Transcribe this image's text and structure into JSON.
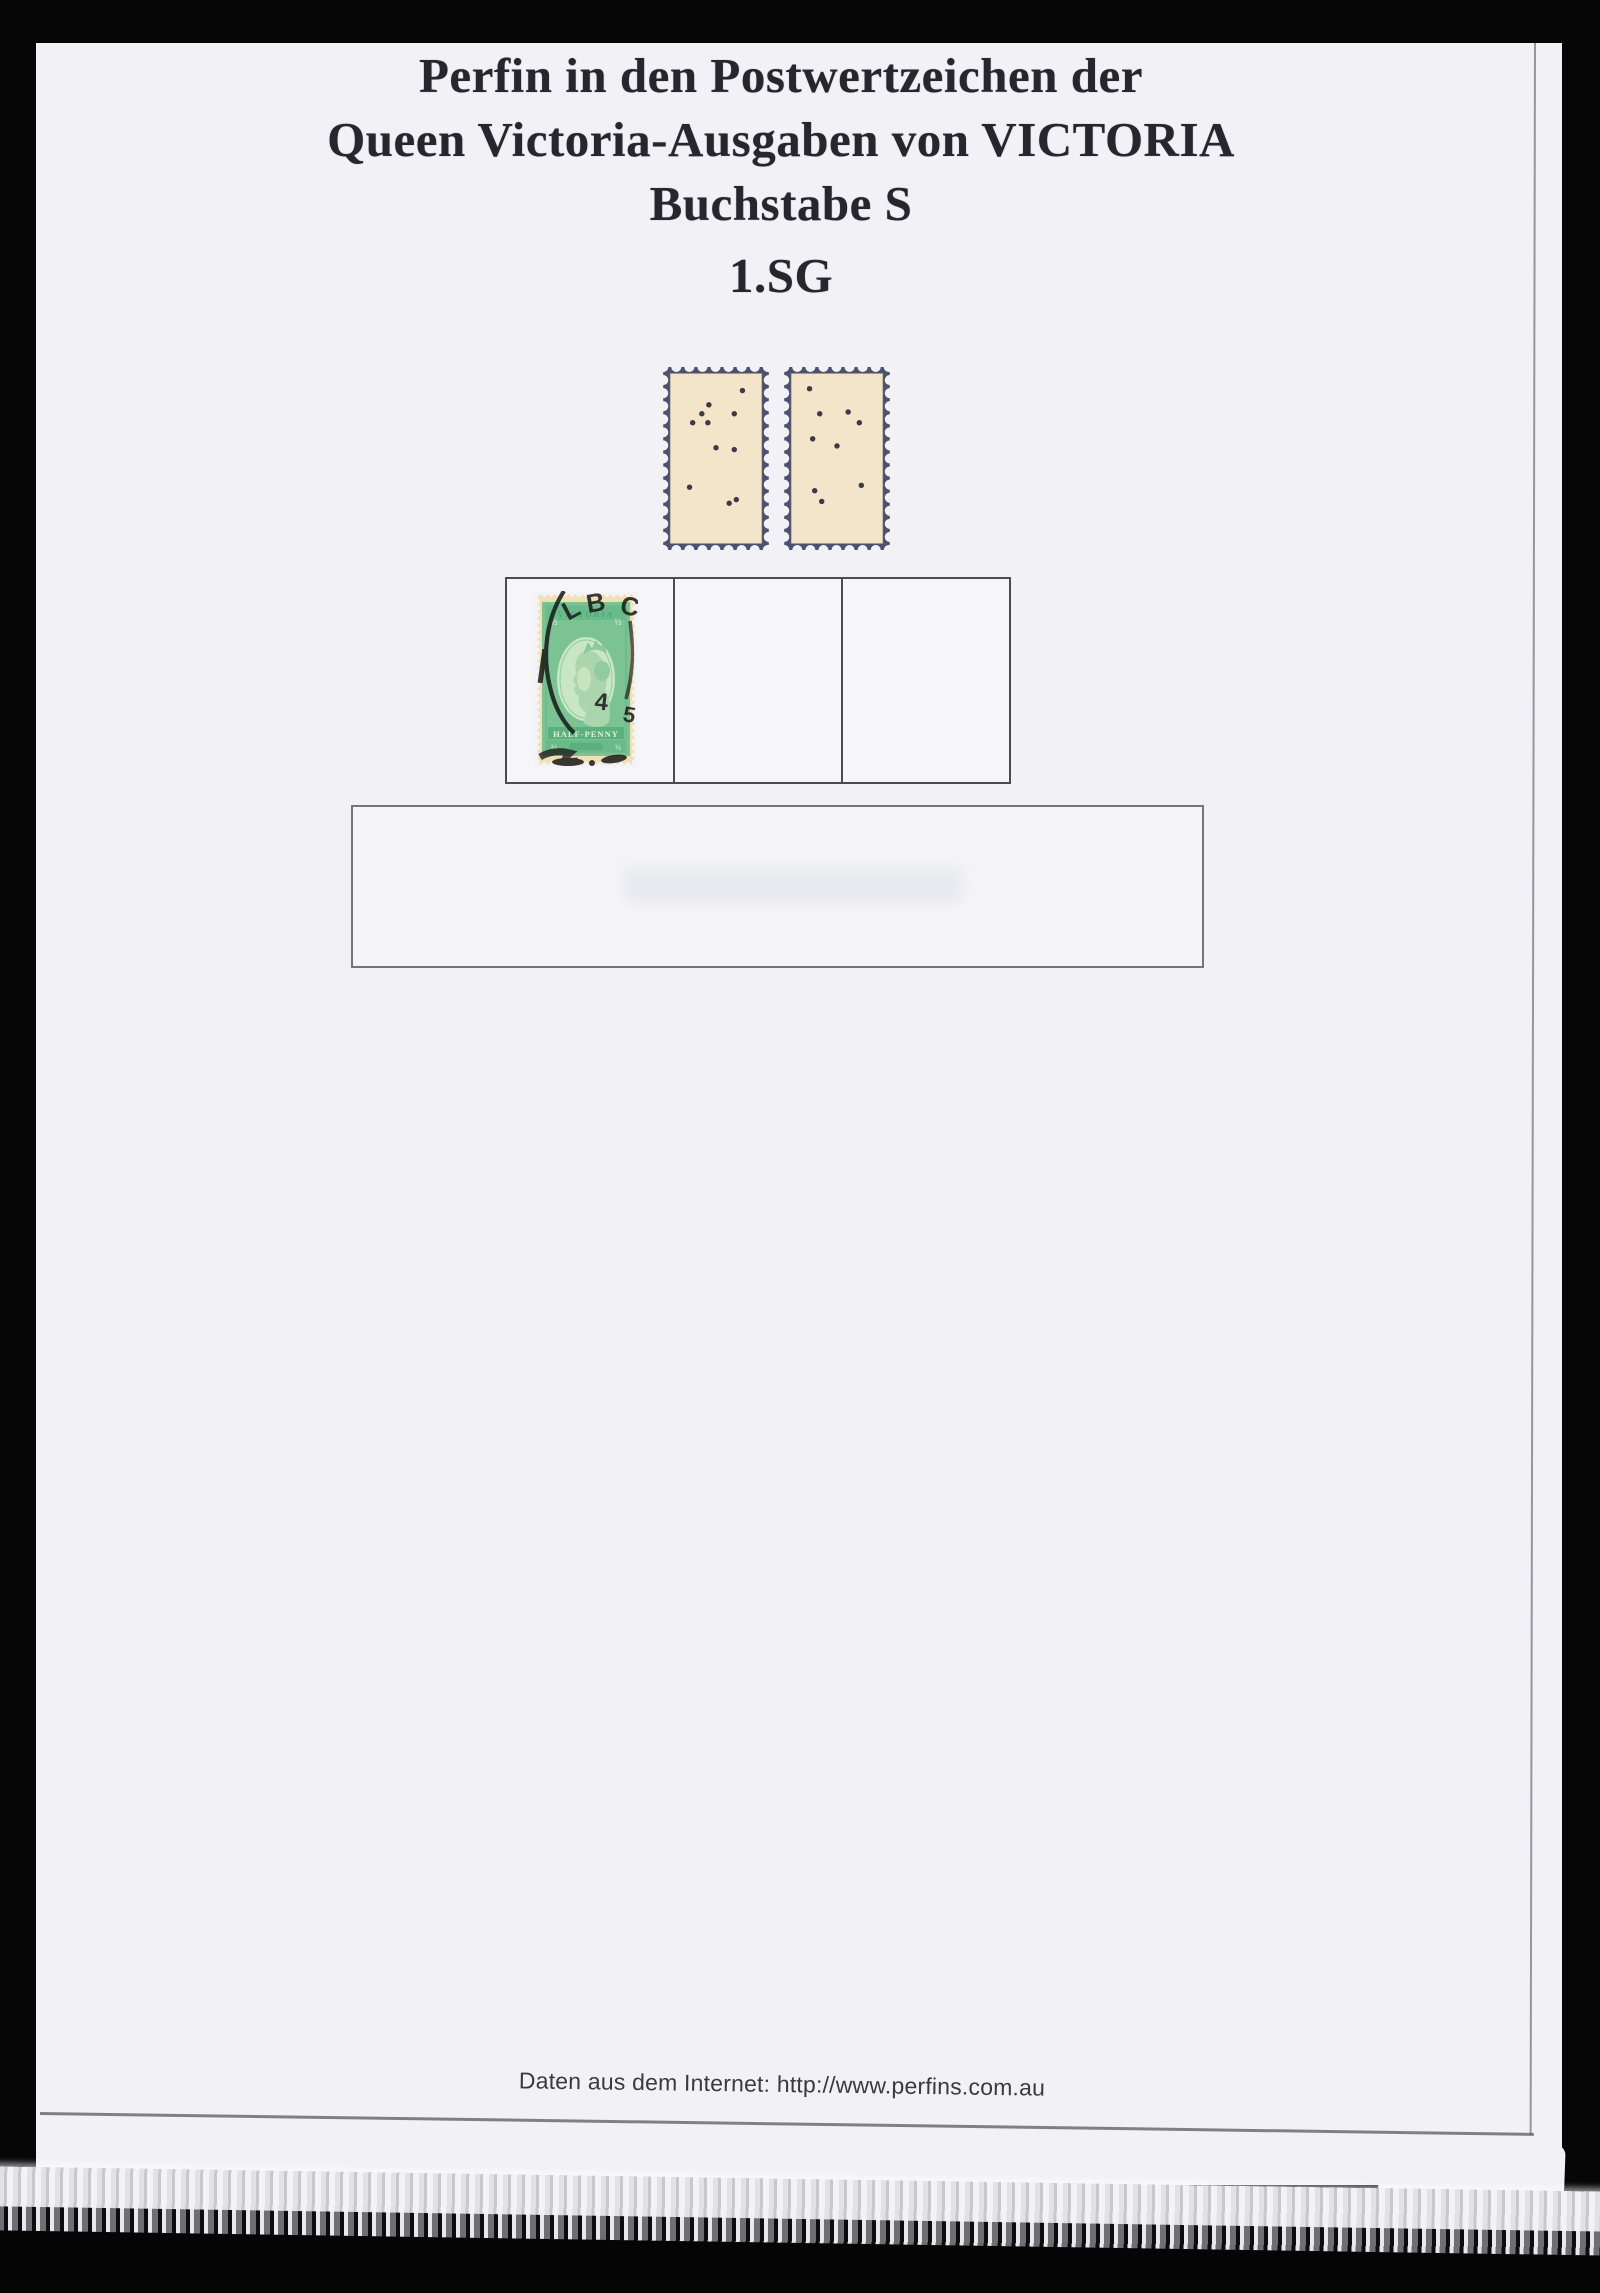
{
  "document": {
    "title_lines": [
      "Perfin in den Postwertzeichen der",
      "Queen Victoria-Ausgaben von VICTORIA",
      "Buchstabe S",
      "1.SG"
    ],
    "footer_source": "Daten aus dem Internet: http://www.perfins.com.au"
  },
  "perfin_backs": {
    "border_color": "#4d5170",
    "paper_color": "#f3e5c9",
    "hole_color": "#3b3b47",
    "page_color": "#f2f2f6",
    "stamps": [
      {
        "name": "perfin-back-left",
        "holes": [
          [
            76,
            12
          ],
          [
            43,
            20
          ],
          [
            36,
            25
          ],
          [
            68,
            25
          ],
          [
            27,
            30
          ],
          [
            42,
            30
          ],
          [
            50,
            44
          ],
          [
            68,
            45
          ],
          [
            24,
            66
          ],
          [
            70,
            73
          ],
          [
            63,
            75
          ]
        ]
      },
      {
        "name": "perfin-back-right",
        "holes": [
          [
            23,
            11
          ],
          [
            33,
            25
          ],
          [
            61,
            24
          ],
          [
            72,
            30
          ],
          [
            26,
            39
          ],
          [
            50,
            43
          ],
          [
            74,
            65
          ],
          [
            28,
            68
          ],
          [
            35,
            74
          ]
        ]
      }
    ]
  },
  "half_penny_stamp": {
    "country_label": "VICTORIA",
    "value_band": "HALF-PENNY",
    "corner_value": "½",
    "postmark": {
      "letters": "LBC",
      "digit_left": "4",
      "digit_right": "5"
    },
    "colors": {
      "paper": "#efe0b6",
      "green": "#7cc394",
      "green_dark": "#5bb07e",
      "green_band": "#6abb8a",
      "oval": "#c9e7c4",
      "cancel": "#161616",
      "mount_bg": "#f3f3f7"
    }
  }
}
